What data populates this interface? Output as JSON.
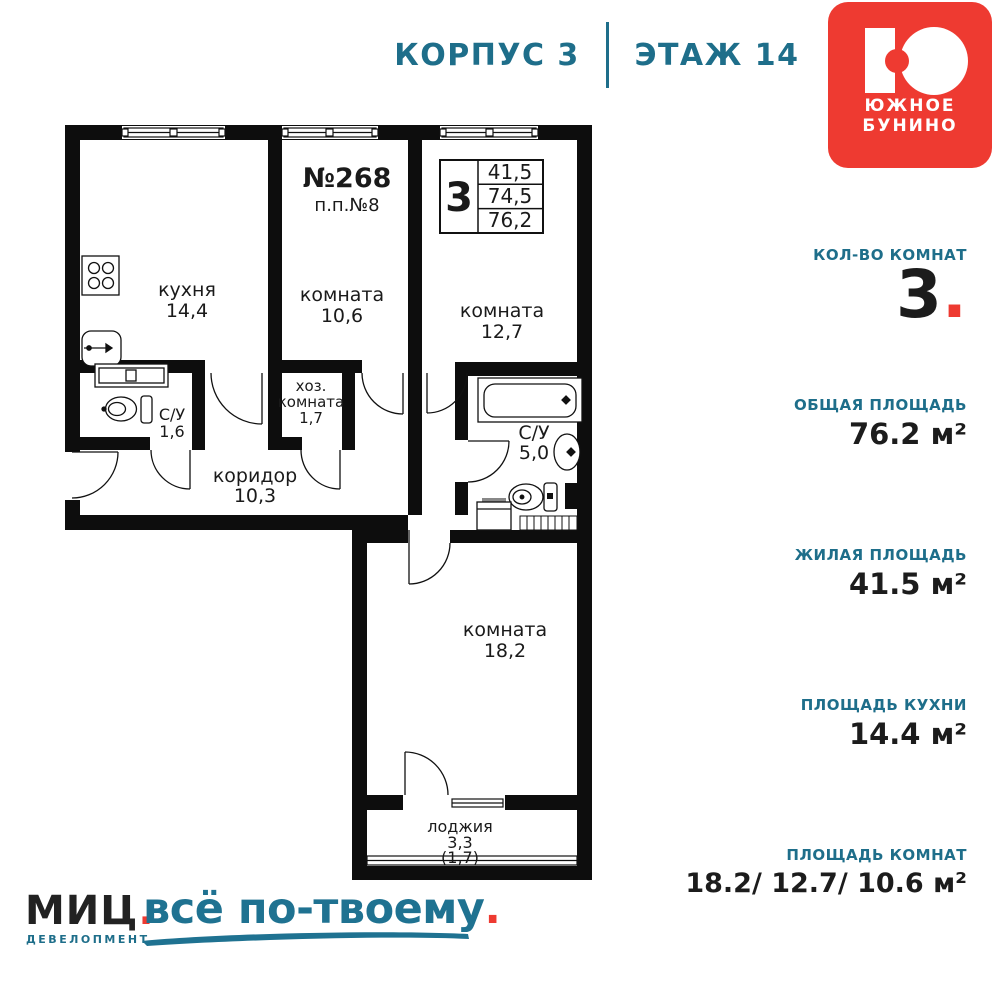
{
  "header": {
    "building": "КОРПУС 3",
    "floor": "ЭТАЖ 14"
  },
  "logo": {
    "name_line1": "ЮЖНОЕ",
    "name_line2": "БУНИНО"
  },
  "plan": {
    "apartment_number": "№268",
    "pp_number": "п.п.№8",
    "info_box": {
      "rooms": "3",
      "values": [
        "41,5",
        "74,5",
        "76,2"
      ]
    },
    "rooms": {
      "kitchen": {
        "name": "кухня",
        "area": "14,4"
      },
      "bedroom1": {
        "name": "комната",
        "area": "10,6"
      },
      "bedroom2": {
        "name": "комната",
        "area": "12,7"
      },
      "utility": {
        "name_line1": "хоз.",
        "name_line2": "комната",
        "area": "1,7"
      },
      "wc_small": {
        "name": "С/У",
        "area": "1,6"
      },
      "corridor": {
        "name": "коридор",
        "area": "10,3"
      },
      "wc_large": {
        "name": "С/У",
        "area": "5,0"
      },
      "bedroom3": {
        "name": "комната",
        "area": "18,2"
      },
      "loggia": {
        "name": "лоджия",
        "area": "3,3",
        "area_coef": "(1,7)"
      }
    }
  },
  "sidebar": {
    "rooms": {
      "label": "КОЛ-ВО КОМНАТ",
      "value": "3",
      "dot": "."
    },
    "sections": [
      {
        "label": "ОБЩАЯ ПЛОЩАДЬ",
        "value": "76.2 м²"
      },
      {
        "label": "ЖИЛАЯ ПЛОЩАДЬ",
        "value": "41.5 м²"
      },
      {
        "label": "ПЛОЩАДЬ КУХНИ",
        "value": "14.4 м²"
      },
      {
        "label": "ПЛОЩАДЬ КОМНАТ",
        "value": "18.2/ 12.7/ 10.6 м²"
      }
    ]
  },
  "footer": {
    "brand": "МИЦ",
    "brand_dot": ".",
    "brand_sub": "ДЕВЕЛОПМЕНТ",
    "slogan": "всё по-твоему",
    "slogan_dot": "."
  },
  "colors": {
    "teal": "#1e6e8a",
    "red": "#ee3a31",
    "wall": "#0d0d0d"
  }
}
